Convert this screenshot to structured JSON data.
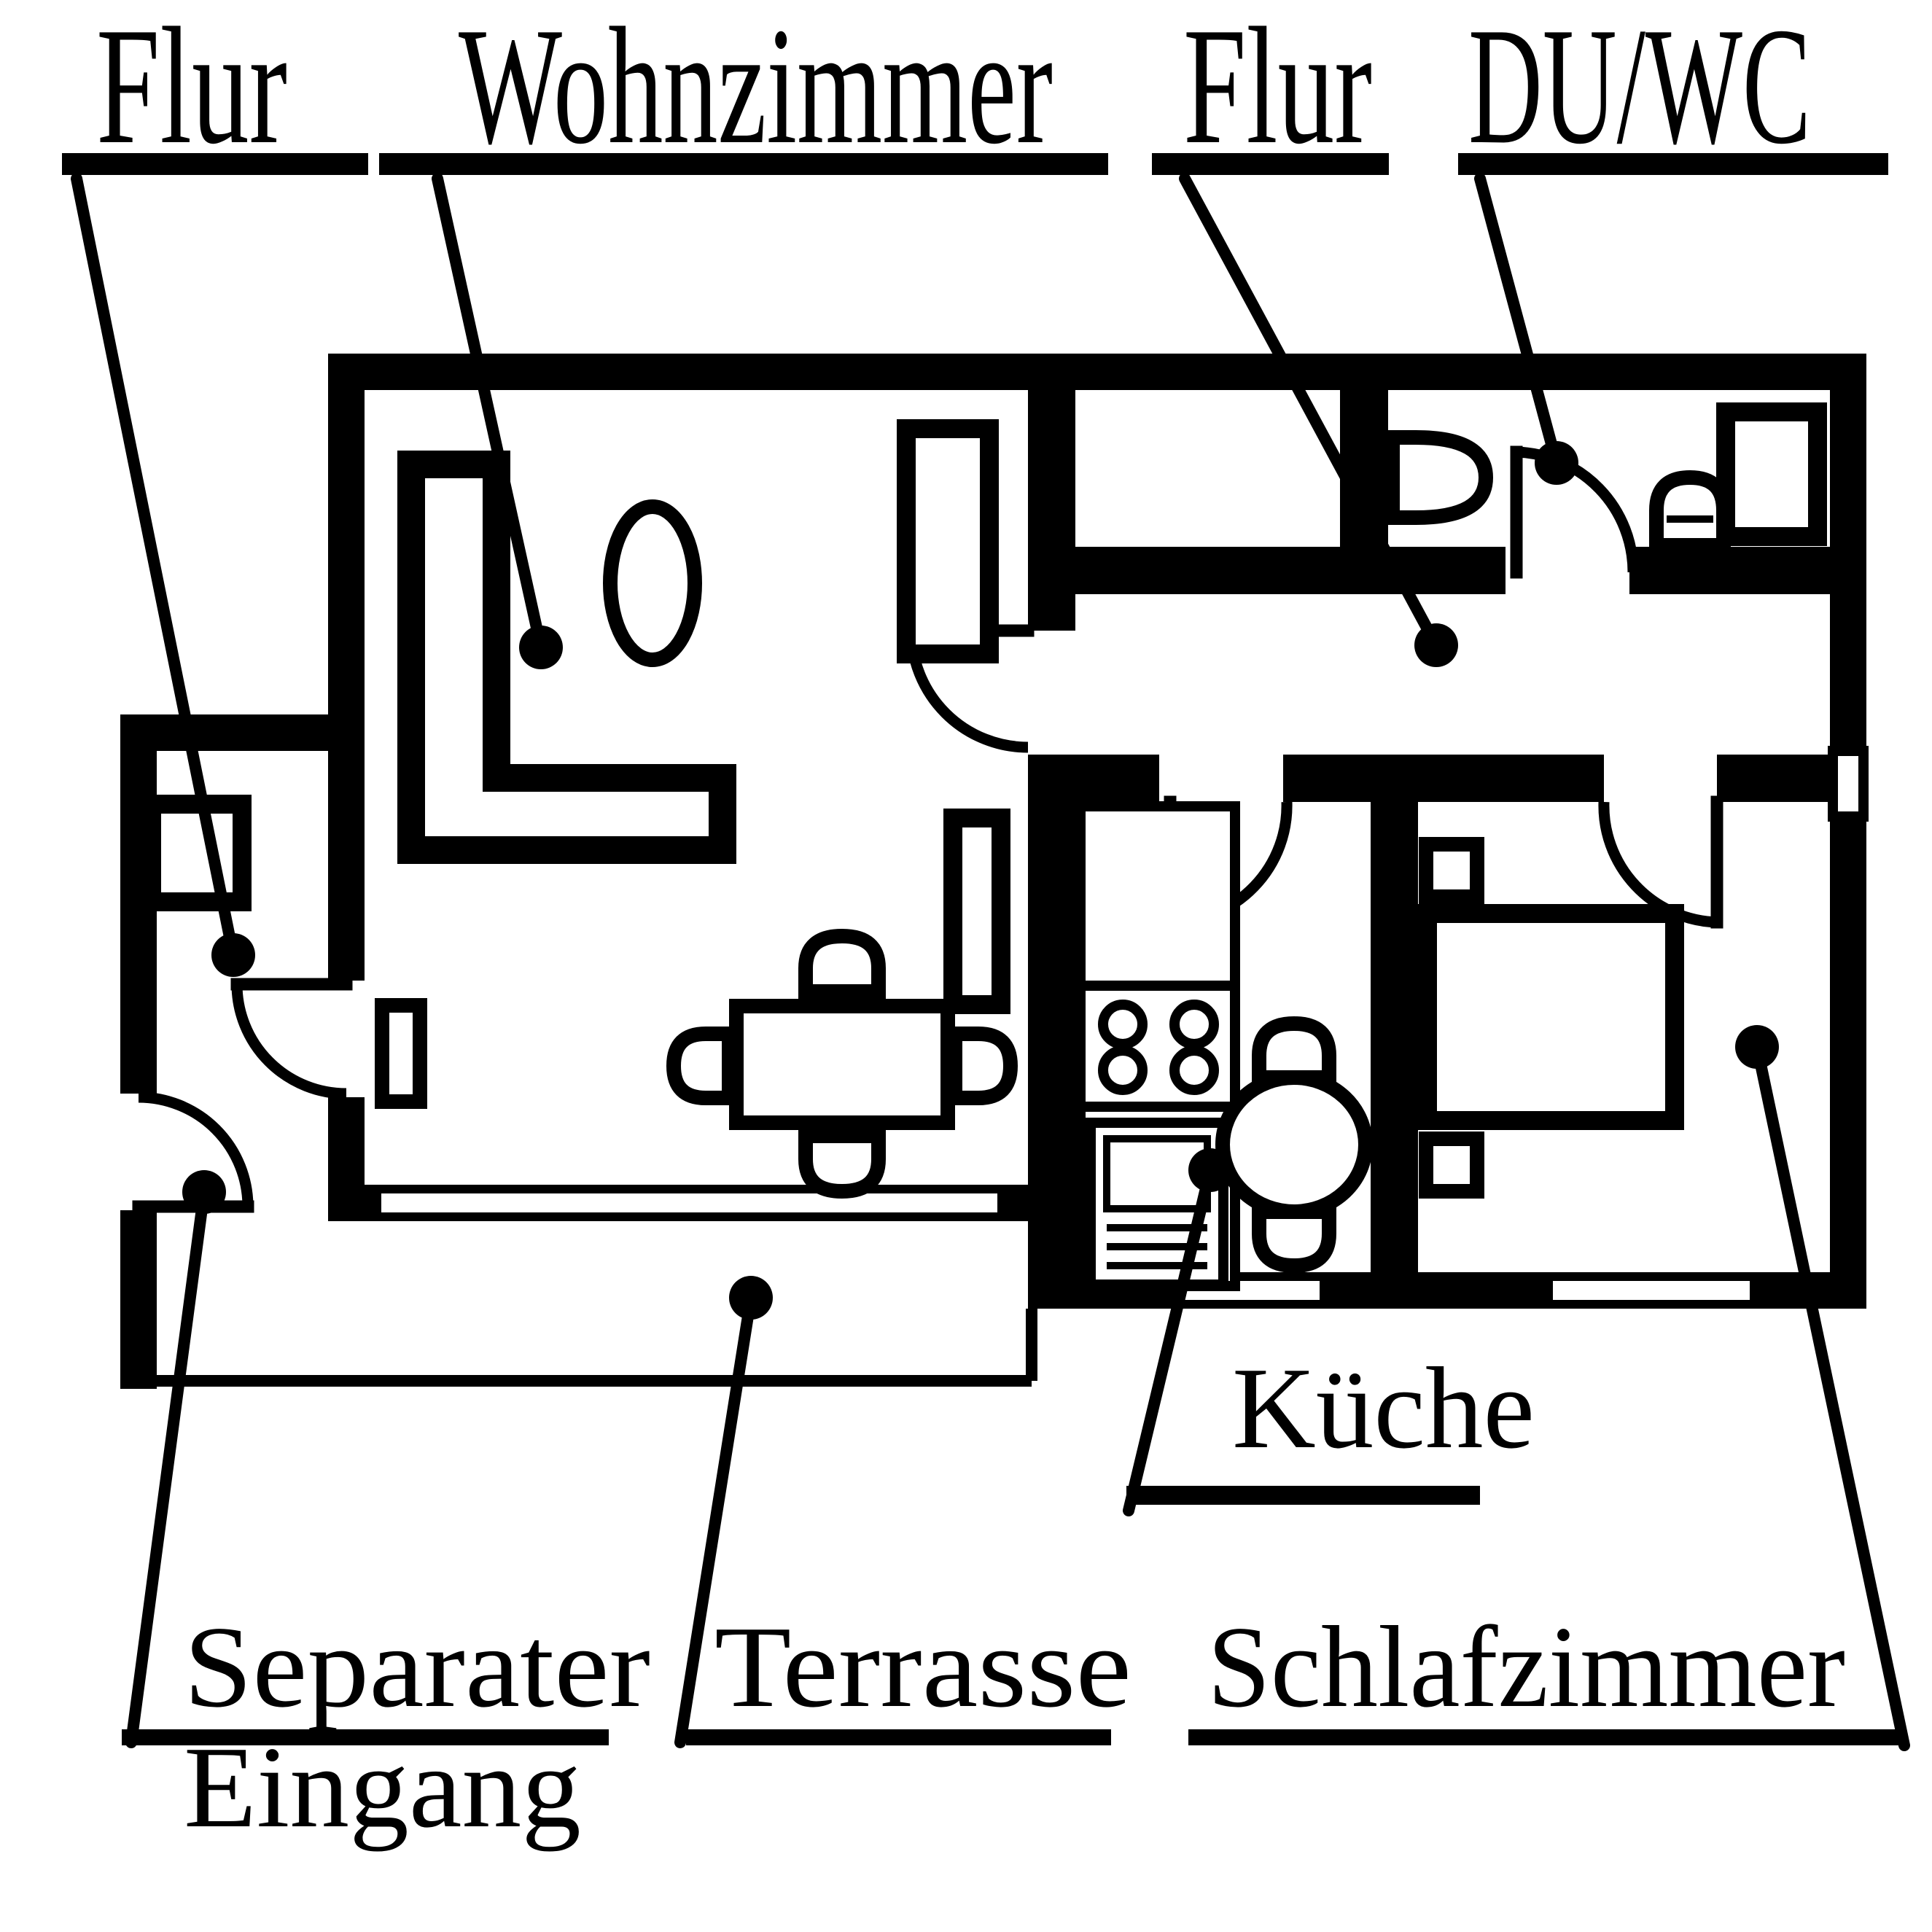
{
  "diagram": {
    "type": "apartment-floor-plan",
    "language": "German",
    "colors": {
      "background": "#ffffff",
      "ink": "#000000"
    },
    "labels": {
      "flur_left": {
        "text": "Flur",
        "points_to": "entrance hallway (left annex)"
      },
      "wohnzimmer": {
        "text": "Wohnzimmer",
        "points_to": "living room"
      },
      "flur_right": {
        "text": "Flur",
        "points_to": "inner hallway"
      },
      "du_wc": {
        "text": "DU/WC",
        "points_to": "shower / WC bathroom"
      },
      "kueche": {
        "text": "Küche",
        "points_to": "kitchen"
      },
      "separater": {
        "text": "Separater",
        "points_to": "separate entrance"
      },
      "eingang": {
        "text": "Eingang",
        "points_to": "separate entrance (second line)"
      },
      "terrasse": {
        "text": "Terrasse",
        "points_to": "terrace"
      },
      "schlafzimmer": {
        "text": "Schlafzimmer",
        "points_to": "bedroom"
      }
    },
    "features": [
      "l-sofa",
      "coffee-table",
      "dining-table",
      "dining-chairs",
      "wardrobe",
      "cabinet",
      "side-table",
      "hall-cabinet",
      "stove-burners",
      "oven",
      "kitchen-table",
      "kitchen-chairs",
      "washbasin",
      "toilet",
      "shower",
      "bed",
      "nightstands",
      "door-arcs",
      "sliding-terrace-door",
      "windows",
      "terrace-outline"
    ]
  }
}
